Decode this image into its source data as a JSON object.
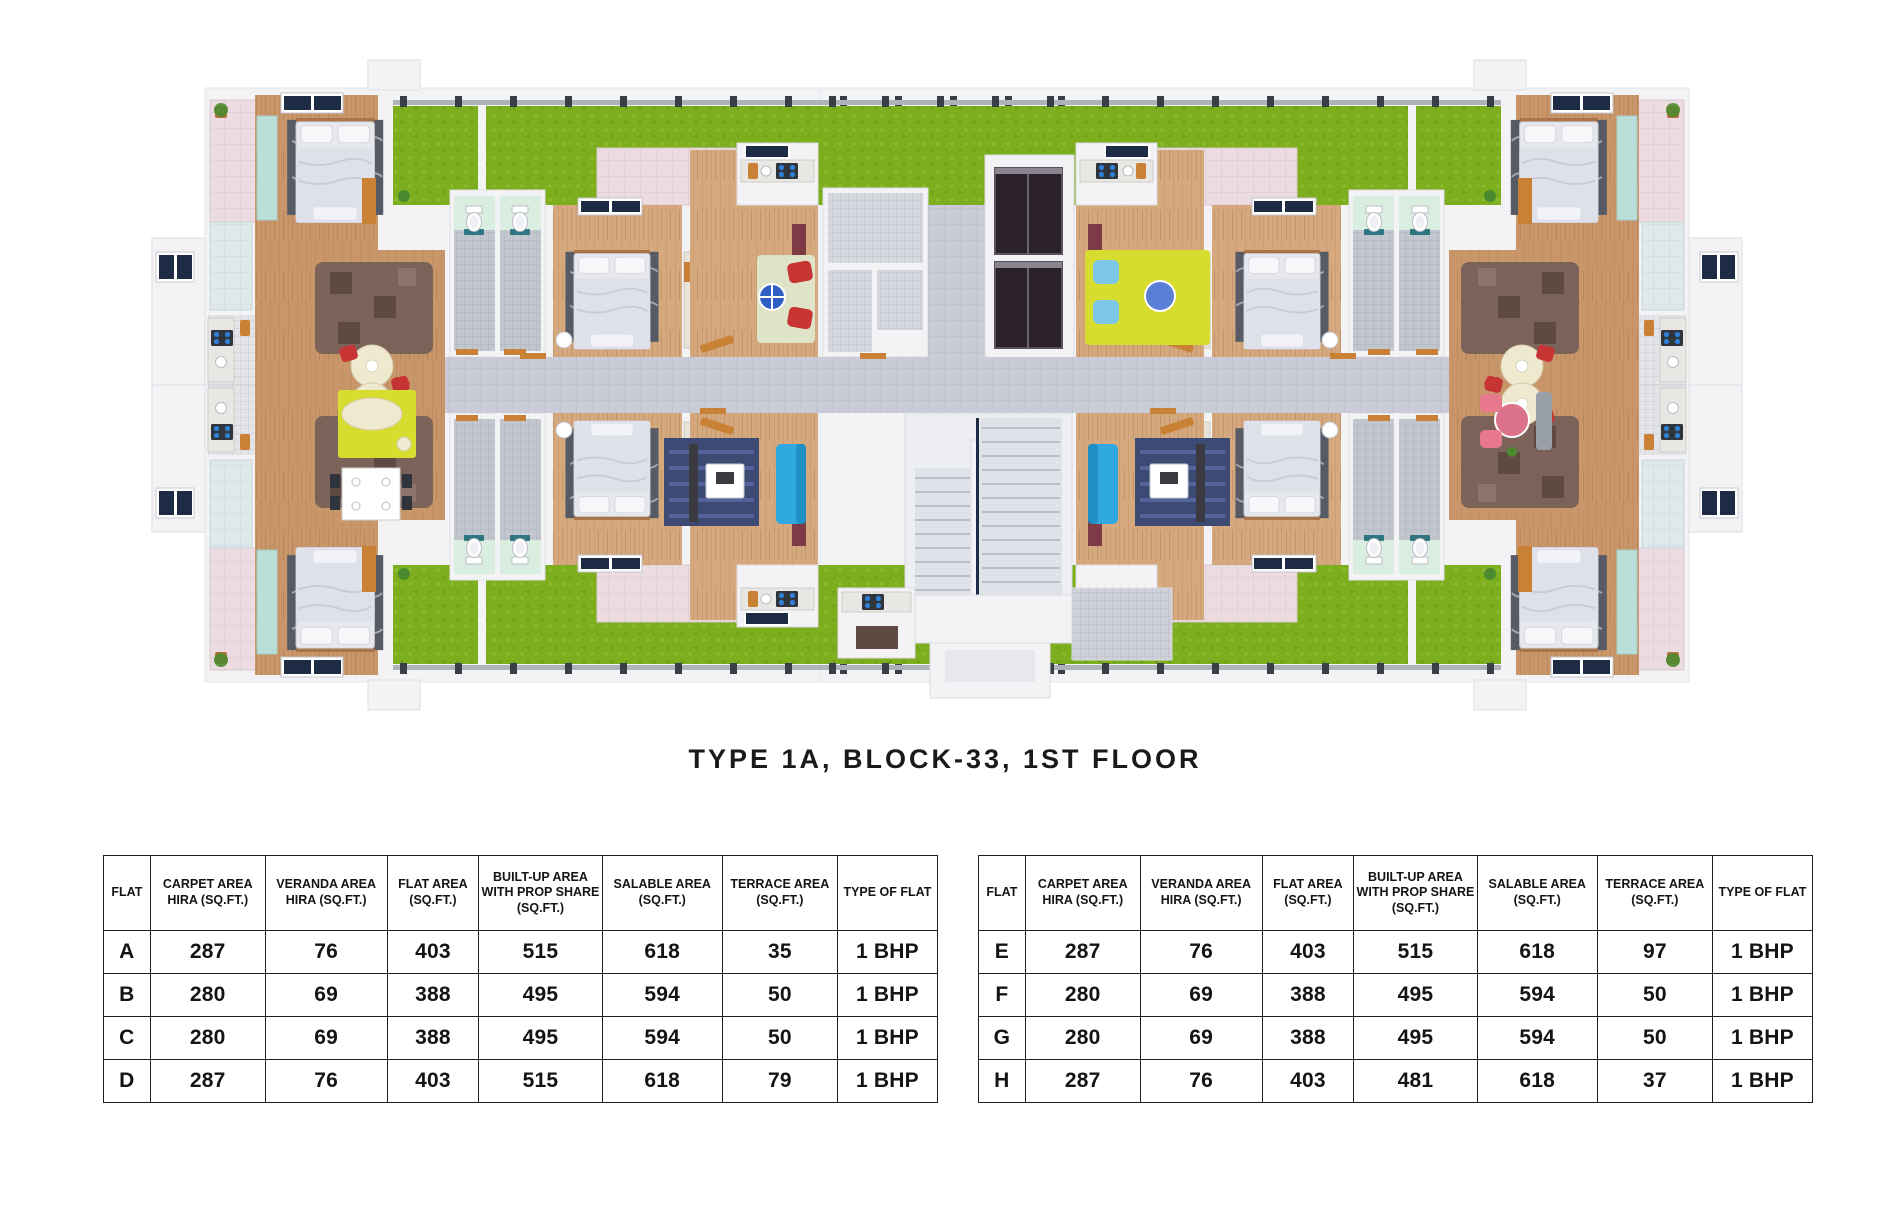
{
  "title": "TYPE 1A, BLOCK-33, 1ST FLOOR",
  "colors": {
    "wall": "#f3f3f6",
    "wallStroke": "#e1e1e8",
    "grass": "#7cae1e",
    "pinkTile": "#ecdce1",
    "blueTile": "#dfe9ec",
    "woodA": "#c9966a",
    "woodB": "#d5a87d",
    "corridor": "#c9ccd7",
    "service": "#d6d8e0",
    "grayRoom": "#ced1da",
    "mint": "#d9eee0",
    "mosaic": "#c2c6cf",
    "shaft": "#2a2228",
    "rug": "#565b66",
    "bedSheet": "#e7e8ee",
    "pillow": "#f7f7fa",
    "blanket": "#dfe1ea",
    "teal": "#badfd9",
    "yellow": "#d7dd2f",
    "cream": "#efe9cf",
    "red": "#c63434",
    "pinkAccent": "#e8798d",
    "blueSofa": "#2ea8de",
    "navyRug": "#3c4a74",
    "glassBlue": "#2f5fc4",
    "orange": "#c98136",
    "brown": "#7b635a",
    "brownDark": "#5f4a43",
    "counter": "#e9e7e3",
    "stoveDark": "#30343c",
    "burnerBlue": "#2f7fd6",
    "skylight": "#1d2b45",
    "landing": "#eceef2",
    "flight": "#dfe3e9",
    "matTeal": "#1f6d78",
    "tvDark": "#3a3a40",
    "cabinetRed": "#7d3b46",
    "sofaGray": "#9aa0a8"
  },
  "tables": {
    "headers": [
      "FLAT",
      "CARPET AREA HIRA (SQ.FT.)",
      "VERANDA AREA HIRA (SQ.FT.)",
      "FLAT AREA (SQ.FT.)",
      "BUILT-UP AREA WITH PROP SHARE (SQ.FT.)",
      "SALABLE AREA (SQ.FT.)",
      "TERRACE AREA (SQ.FT.)",
      "TYPE OF FLAT"
    ],
    "left_rows": [
      [
        "A",
        "287",
        "76",
        "403",
        "515",
        "618",
        "35",
        "1 BHP"
      ],
      [
        "B",
        "280",
        "69",
        "388",
        "495",
        "594",
        "50",
        "1 BHP"
      ],
      [
        "C",
        "280",
        "69",
        "388",
        "495",
        "594",
        "50",
        "1 BHP"
      ],
      [
        "D",
        "287",
        "76",
        "403",
        "515",
        "618",
        "79",
        "1 BHP"
      ]
    ],
    "right_rows": [
      [
        "E",
        "287",
        "76",
        "403",
        "515",
        "618",
        "97",
        "1 BHP"
      ],
      [
        "F",
        "280",
        "69",
        "388",
        "495",
        "594",
        "50",
        "1 BHP"
      ],
      [
        "G",
        "280",
        "69",
        "388",
        "495",
        "594",
        "50",
        "1 BHP"
      ],
      [
        "H",
        "287",
        "76",
        "403",
        "481",
        "618",
        "37",
        "1 BHP"
      ]
    ]
  }
}
